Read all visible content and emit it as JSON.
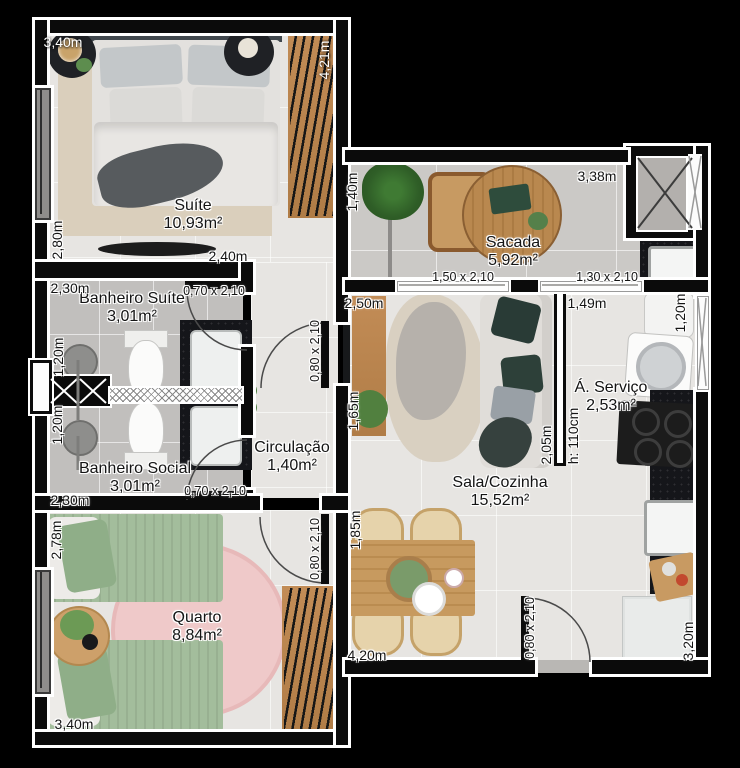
{
  "plan": {
    "title": "Apartment floor plan",
    "colors": {
      "background": "#000000",
      "wall": "#0b0b0b",
      "wall_outline": "#ffffff",
      "floor": "#e7e5e2",
      "bathroom_floor": "#c1bfbd",
      "balcony_floor": "#cbc9c6",
      "wood": "#c28c56",
      "counter_granite": "#15161a",
      "bed_green": "#a3bd9c",
      "rug_pink": "#efc9c9",
      "rug_beige": "#dacfbc"
    },
    "rooms": [
      {
        "id": "suite",
        "name": "Suíte",
        "area": "10,93m²",
        "cx": 193,
        "cy": 215
      },
      {
        "id": "banheiro-suite",
        "name": "Banheiro Suíte",
        "area": "3,01m²",
        "cx": 132,
        "cy": 308
      },
      {
        "id": "banheiro-social",
        "name": "Banheiro Social",
        "area": "3,01m²",
        "cx": 135,
        "cy": 478
      },
      {
        "id": "circulacao",
        "name": "Circulação",
        "area": "1,40m²",
        "cx": 292,
        "cy": 457
      },
      {
        "id": "quarto",
        "name": "Quarto",
        "area": "8,84m²",
        "cx": 197,
        "cy": 627
      },
      {
        "id": "sacada",
        "name": "Sacada",
        "area": "5,92m²",
        "cx": 513,
        "cy": 252
      },
      {
        "id": "sala-cozinha",
        "name": "Sala/Cozinha",
        "area": "15,52m²",
        "cx": 500,
        "cy": 492
      },
      {
        "id": "a-servico",
        "name": "Á. Serviço",
        "area": "2,53m²",
        "cx": 611,
        "cy": 397
      }
    ],
    "dims": [
      {
        "id": "suite-width-top",
        "text": "3,40m",
        "x": 63,
        "y": 42,
        "w": 1
      },
      {
        "id": "suite-depth-right",
        "text": "4,21m",
        "x": 324,
        "y": 60,
        "v": 1,
        "w": 1
      },
      {
        "id": "suite-left",
        "text": "2,80m",
        "x": 57,
        "y": 240,
        "v": 1
      },
      {
        "id": "suite-bottom",
        "text": "2,40m",
        "x": 228,
        "y": 256
      },
      {
        "id": "banheiro-suite-top",
        "text": "2,30m",
        "x": 70,
        "y": 288
      },
      {
        "id": "banheiro-suite-door",
        "text": "0,70 x 2,10",
        "x": 214,
        "y": 291,
        "s": 1
      },
      {
        "id": "banheiro-suite-left",
        "text": "1,20m",
        "x": 58,
        "y": 357,
        "v": 1
      },
      {
        "id": "banheiro-social-left",
        "text": "1,20m",
        "x": 57,
        "y": 425,
        "v": 1
      },
      {
        "id": "banheiro-social-door",
        "text": "0,70 x 2,10",
        "x": 215,
        "y": 491,
        "s": 1
      },
      {
        "id": "banheiro-social-bottom",
        "text": "2,30m",
        "x": 70,
        "y": 500
      },
      {
        "id": "circ-sala-door",
        "text": "0,80 x 2,10",
        "x": 315,
        "y": 351,
        "v": 1,
        "s": 1
      },
      {
        "id": "quarto-door",
        "text": "0,80 x 2,10",
        "x": 315,
        "y": 549,
        "v": 1,
        "s": 1
      },
      {
        "id": "quarto-left",
        "text": "2,78m",
        "x": 56,
        "y": 540,
        "v": 1
      },
      {
        "id": "quarto-bottom",
        "text": "3,40m",
        "x": 74,
        "y": 724
      },
      {
        "id": "sacada-left",
        "text": "1,40m",
        "x": 352,
        "y": 192,
        "v": 1
      },
      {
        "id": "sacada-top",
        "text": "3,38m",
        "x": 597,
        "y": 176
      },
      {
        "id": "sacada-window-1",
        "text": "1,50 x 2,10",
        "x": 463,
        "y": 277,
        "s": 1
      },
      {
        "id": "sacada-window-2",
        "text": "1,30 x 2,10",
        "x": 607,
        "y": 277,
        "s": 1
      },
      {
        "id": "sala-top-left",
        "text": "2,50m",
        "x": 364,
        "y": 303
      },
      {
        "id": "sala-top-right",
        "text": "1,49m",
        "x": 587,
        "y": 303
      },
      {
        "id": "servico-right",
        "text": "1,20m",
        "x": 680,
        "y": 313,
        "v": 1
      },
      {
        "id": "sala-left-upper",
        "text": "1,65m",
        "x": 353,
        "y": 411,
        "v": 1
      },
      {
        "id": "sofa-wall",
        "text": "2,05m",
        "x": 546,
        "y": 445,
        "v": 1
      },
      {
        "id": "half-wall-height",
        "text": "h: 110cm",
        "x": 573,
        "y": 436,
        "v": 1
      },
      {
        "id": "sala-left-lower",
        "text": "1,85m",
        "x": 355,
        "y": 530,
        "v": 1
      },
      {
        "id": "sala-bottom",
        "text": "4,20m",
        "x": 367,
        "y": 655
      },
      {
        "id": "entry-door",
        "text": "0,80 x 2,10",
        "x": 530,
        "y": 628,
        "v": 1,
        "s": 1
      },
      {
        "id": "kitchen-right",
        "text": "3,20m",
        "x": 688,
        "y": 641,
        "v": 1
      }
    ]
  }
}
